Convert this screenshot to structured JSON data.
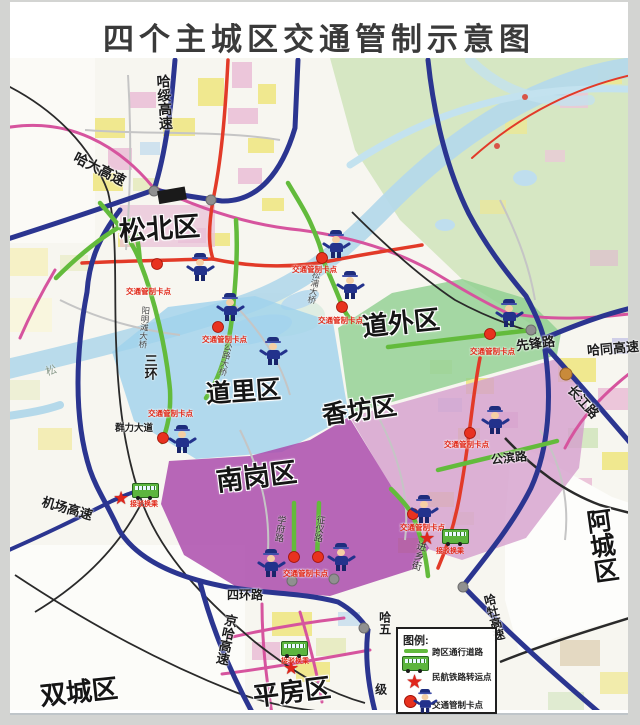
{
  "title": "四个主城区交通管制示意图",
  "districts": {
    "songbei": "松北区",
    "daowai": "道外区",
    "daoli": "道里区",
    "xiangfang": "香坊区",
    "nangang": "南岗区",
    "acheng": "阿城区",
    "shuangcheng": "双城区",
    "pingfang": "平房区"
  },
  "roads": {
    "hasui": "哈绥高速",
    "hada": "哈大高速",
    "sanhuan": "三环",
    "yangmingtan_bridge": "阳明滩大桥",
    "songpu_bridge": "松浦大桥",
    "gonglu_bridge": "公路大桥",
    "qunli": "群力大道",
    "xianfeng": "先锋路",
    "hatong": "哈同高速",
    "changjiang": "长江路",
    "gongbin": "公滨路",
    "jichang": "机场高速",
    "sihuan": "四环路",
    "jingha": "京哈高速",
    "hamu": "哈牡高速",
    "hawu_upper": "哈五",
    "hawu_lower": "级",
    "jinxiang": "进乡街",
    "xuefu": "学府路",
    "zhengyi": "征仪路",
    "songhua": "松"
  },
  "markers": {
    "checkpoint_label": "交通管制卡点",
    "transfer_label": "接驳换乘",
    "star_glyph": "★"
  },
  "legend": {
    "title": "图例:",
    "items": [
      {
        "label": "跨区通行道路"
      },
      {
        "label": "民航铁路转运点"
      },
      {
        "label": "交通管制卡点"
      }
    ]
  },
  "colors": {
    "highway": "#2b3590",
    "transit_road": "#63bb3c",
    "checkpoint": "#e8321f",
    "zone_daowai": "#8ecf90",
    "zone_daoli": "#9fd2ec",
    "zone_xiangfang": "#d49fcd",
    "zone_nangang": "#ab4cad"
  }
}
